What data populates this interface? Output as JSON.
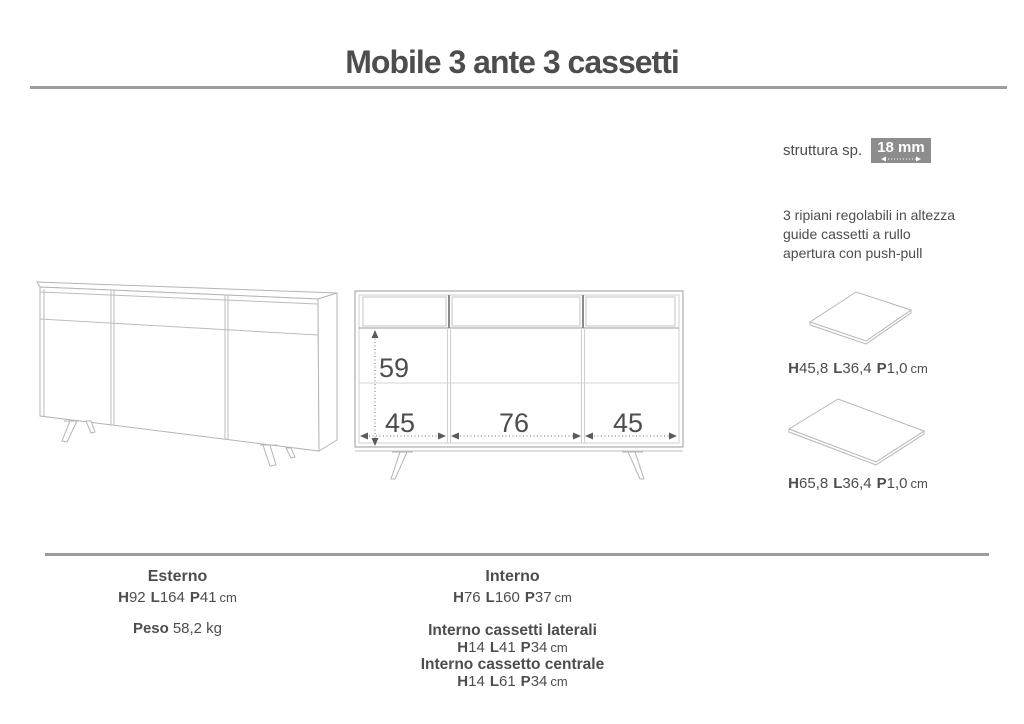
{
  "title": "Mobile 3 ante 3 cassetti",
  "specs": {
    "struttura_label": "struttura sp.",
    "struttura_value": "18 mm",
    "features": [
      "3 ripiani regolabili in altezza",
      "guide cassetti a rullo",
      "apertura con push-pull"
    ]
  },
  "letters": {
    "h": "H",
    "l": "L",
    "p": "P"
  },
  "front_view": {
    "inner_height": "59",
    "widths": [
      "45",
      "76",
      "45"
    ]
  },
  "shelves": [
    {
      "h": "45,8",
      "l": "36,4",
      "p": "1,0",
      "unit": "cm"
    },
    {
      "h": "65,8",
      "l": "36,4",
      "p": "1,0",
      "unit": "cm"
    }
  ],
  "bottom": {
    "esterno": {
      "title": "Esterno",
      "h": "92",
      "l": "164",
      "p": "41",
      "unit": "cm"
    },
    "peso": {
      "label": "Peso",
      "value": "58,2 kg"
    },
    "interno": {
      "title": "Interno",
      "h": "76",
      "l": "160",
      "p": "37",
      "unit": "cm"
    },
    "cassetti_laterali": {
      "title": "Interno cassetti laterali",
      "h": "14",
      "l": "41",
      "p": "34",
      "unit": "cm"
    },
    "cassetto_centrale": {
      "title": "Interno cassetto centrale",
      "h": "14",
      "l": "61",
      "p": "34",
      "unit": "cm"
    }
  }
}
